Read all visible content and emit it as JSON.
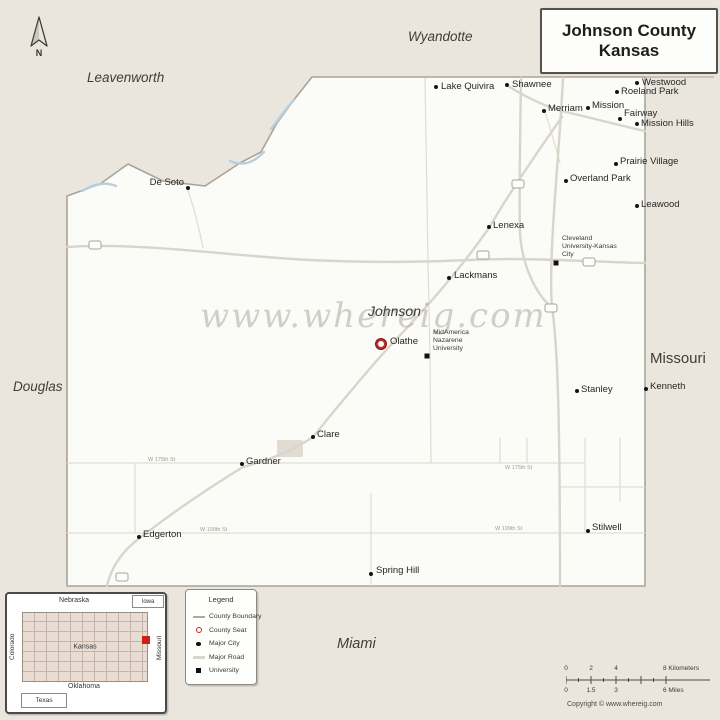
{
  "title": {
    "line1": "Johnson County",
    "line2": "Kansas"
  },
  "compass": {
    "label": "N"
  },
  "watermark": "www.whereig.com",
  "regions": [
    {
      "name": "Leavenworth",
      "x": 87,
      "y": 70,
      "italic": true,
      "size": 13.5
    },
    {
      "name": "Wyandotte",
      "x": 408,
      "y": 29,
      "italic": true,
      "size": 13.5
    },
    {
      "name": "Douglas",
      "x": 13,
      "y": 379,
      "italic": true,
      "size": 13.5
    },
    {
      "name": "Miami",
      "x": 337,
      "y": 636,
      "italic": true,
      "size": 14.5
    },
    {
      "name": "Missouri",
      "x": 650,
      "y": 350,
      "italic": false,
      "size": 15
    },
    {
      "name": "Johnson",
      "x": 368,
      "y": 303,
      "italic": true,
      "size": 14
    }
  ],
  "cities": [
    {
      "name": "Lake Quivira",
      "type": "city",
      "mx": 436,
      "my": 87,
      "lx": 441,
      "ly": 81
    },
    {
      "name": "Shawnee",
      "type": "city",
      "mx": 507,
      "my": 85,
      "lx": 512,
      "ly": 79
    },
    {
      "name": "Merriam",
      "type": "city",
      "mx": 544,
      "my": 111,
      "lx": 548,
      "ly": 103
    },
    {
      "name": "Mission",
      "type": "city",
      "mx": 588,
      "my": 108,
      "lx": 592,
      "ly": 100
    },
    {
      "name": "Westwood",
      "type": "city",
      "mx": 637,
      "my": 83,
      "lx": 642,
      "ly": 77
    },
    {
      "name": "Roeland Park",
      "type": "city",
      "mx": 617,
      "my": 92,
      "lx": 621,
      "ly": 86
    },
    {
      "name": "Fairway",
      "type": "city",
      "mx": 620,
      "my": 119,
      "lx": 624,
      "ly": 108
    },
    {
      "name": "Mission Hills",
      "type": "city",
      "mx": 637,
      "my": 124,
      "lx": 641,
      "ly": 118
    },
    {
      "name": "Prairie Village",
      "type": "city",
      "mx": 616,
      "my": 164,
      "lx": 620,
      "ly": 156
    },
    {
      "name": "Overland Park",
      "type": "city",
      "mx": 566,
      "my": 181,
      "lx": 570,
      "ly": 173
    },
    {
      "name": "Leawood",
      "type": "city",
      "mx": 637,
      "my": 206,
      "lx": 641,
      "ly": 199
    },
    {
      "name": "De Soto",
      "type": "city",
      "mx": 188,
      "my": 188,
      "lx": 184,
      "ly": 177,
      "label_side": "left"
    },
    {
      "name": "Lenexa",
      "type": "city",
      "mx": 489,
      "my": 227,
      "lx": 493,
      "ly": 220
    },
    {
      "name": "Lackmans",
      "type": "city",
      "mx": 449,
      "my": 278,
      "lx": 454,
      "ly": 270
    },
    {
      "name": "Olathe",
      "type": "seat",
      "mx": 381,
      "my": 344,
      "lx": 390,
      "ly": 336
    },
    {
      "name": "Stanley",
      "type": "city",
      "mx": 577,
      "my": 391,
      "lx": 581,
      "ly": 384
    },
    {
      "name": "Kenneth",
      "type": "city",
      "mx": 646,
      "my": 389,
      "lx": 650,
      "ly": 381
    },
    {
      "name": "Clare",
      "type": "city",
      "mx": 313,
      "my": 437,
      "lx": 317,
      "ly": 429
    },
    {
      "name": "Gardner",
      "type": "city",
      "mx": 242,
      "my": 464,
      "lx": 246,
      "ly": 456
    },
    {
      "name": "Edgerton",
      "type": "city",
      "mx": 139,
      "my": 537,
      "lx": 143,
      "ly": 529
    },
    {
      "name": "Stilwell",
      "type": "city",
      "mx": 588,
      "my": 531,
      "lx": 592,
      "ly": 522
    },
    {
      "name": "Spring Hill",
      "type": "city",
      "mx": 371,
      "my": 574,
      "lx": 376,
      "ly": 565
    },
    {
      "name": "Cleveland\nUniversity-Kansas\nCity",
      "type": "university",
      "mx": 556,
      "my": 263,
      "lx": 562,
      "ly": 235
    },
    {
      "name": "MidAmerica\nNazarene\nUniversity",
      "type": "university",
      "mx": 427,
      "my": 356,
      "lx": 433,
      "ly": 329
    }
  ],
  "road_labels": [
    {
      "text": "W 175th St",
      "x": 148,
      "y": 457
    },
    {
      "text": "W 175th St",
      "x": 505,
      "y": 465
    },
    {
      "text": "W 199th St",
      "x": 200,
      "y": 527
    },
    {
      "text": "W 199th St",
      "x": 495,
      "y": 526
    }
  ],
  "legend": {
    "title": "Legend",
    "items": [
      {
        "label": "County Boundary",
        "swatch": "boundary-line"
      },
      {
        "label": "County Seat",
        "swatch": "seat-dot"
      },
      {
        "label": "Major City",
        "swatch": "city-dot"
      },
      {
        "label": "Major Road",
        "swatch": "road-line"
      },
      {
        "label": "University",
        "swatch": "univ-square"
      }
    ]
  },
  "inset": {
    "labels": {
      "nebraska": "Nebraska",
      "iowa": "Iowa",
      "colorado": "Colorado",
      "kansas": "Kansas",
      "missouri": "Missouri",
      "oklahoma": "Oklahoma",
      "texas": "Texas"
    },
    "highlight_color": "#cc2017"
  },
  "scalebar": {
    "km": [
      "0",
      "2",
      "4",
      "8"
    ],
    "km_unit": "Kilometers",
    "mi": [
      "0",
      "1.5",
      "3",
      "6"
    ],
    "mi_unit": "Miles"
  },
  "copyright": "Copyright © www.whereig.com",
  "colors": {
    "background": "#eae6dd",
    "county_fill": "#fbfbf8",
    "boundary": "#a8a49b",
    "major_road": "#d9d5cb",
    "minor_road": "#e2ded5",
    "river": "#b7cfdc",
    "county_seat": "#c62b22",
    "marker": "#141414"
  }
}
